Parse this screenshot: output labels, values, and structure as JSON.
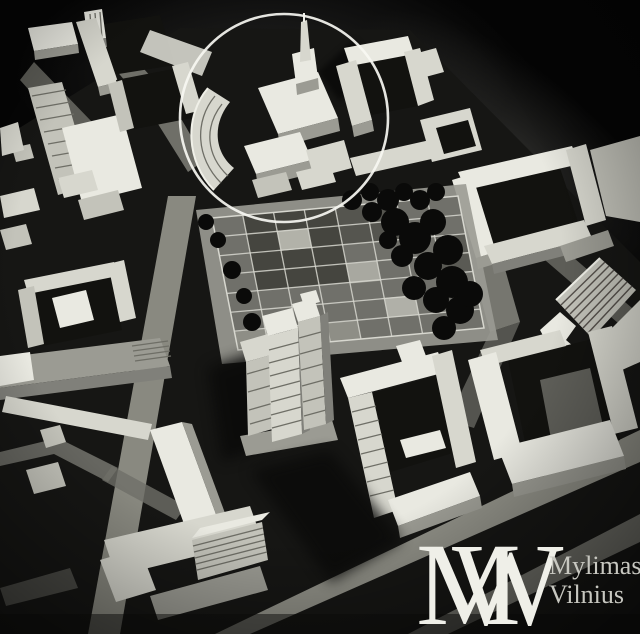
{
  "scene": {
    "description": "Black-and-white aerial photograph of a white architectural scale model of a city district, dark background",
    "features": [
      "church building with spire highlighted by a hand-drawn circle",
      "crescent-shaped terraced building",
      "central plaza with square paving grid",
      "cluster of dark model trees",
      "stepped high-rise tower with floor lines",
      "perimeter courtyard housing blocks",
      "ribbed slab apartment buildings",
      "diagonal streets"
    ]
  },
  "annotation": {
    "shape": "circle",
    "color": "#f7f7f2"
  },
  "watermark": {
    "monogram_left": "M",
    "monogram_right": "W",
    "line1": "Mylimas",
    "line2": "Vilnius",
    "monogram_color": "#efefe8",
    "text_color": "#c7c7c0"
  },
  "palette": {
    "background": "#050505",
    "building_light": "#e9e9e1",
    "building_mid": "#c3c3ba",
    "building_shade": "#9b9b93",
    "courtyard_dark": "#12120f",
    "road": "#8f8f86",
    "plaza_tile": "#70706a",
    "plaza_line": "#d7d7cf",
    "tree": "#0a0a09",
    "shadow": "#0b0b0a"
  }
}
